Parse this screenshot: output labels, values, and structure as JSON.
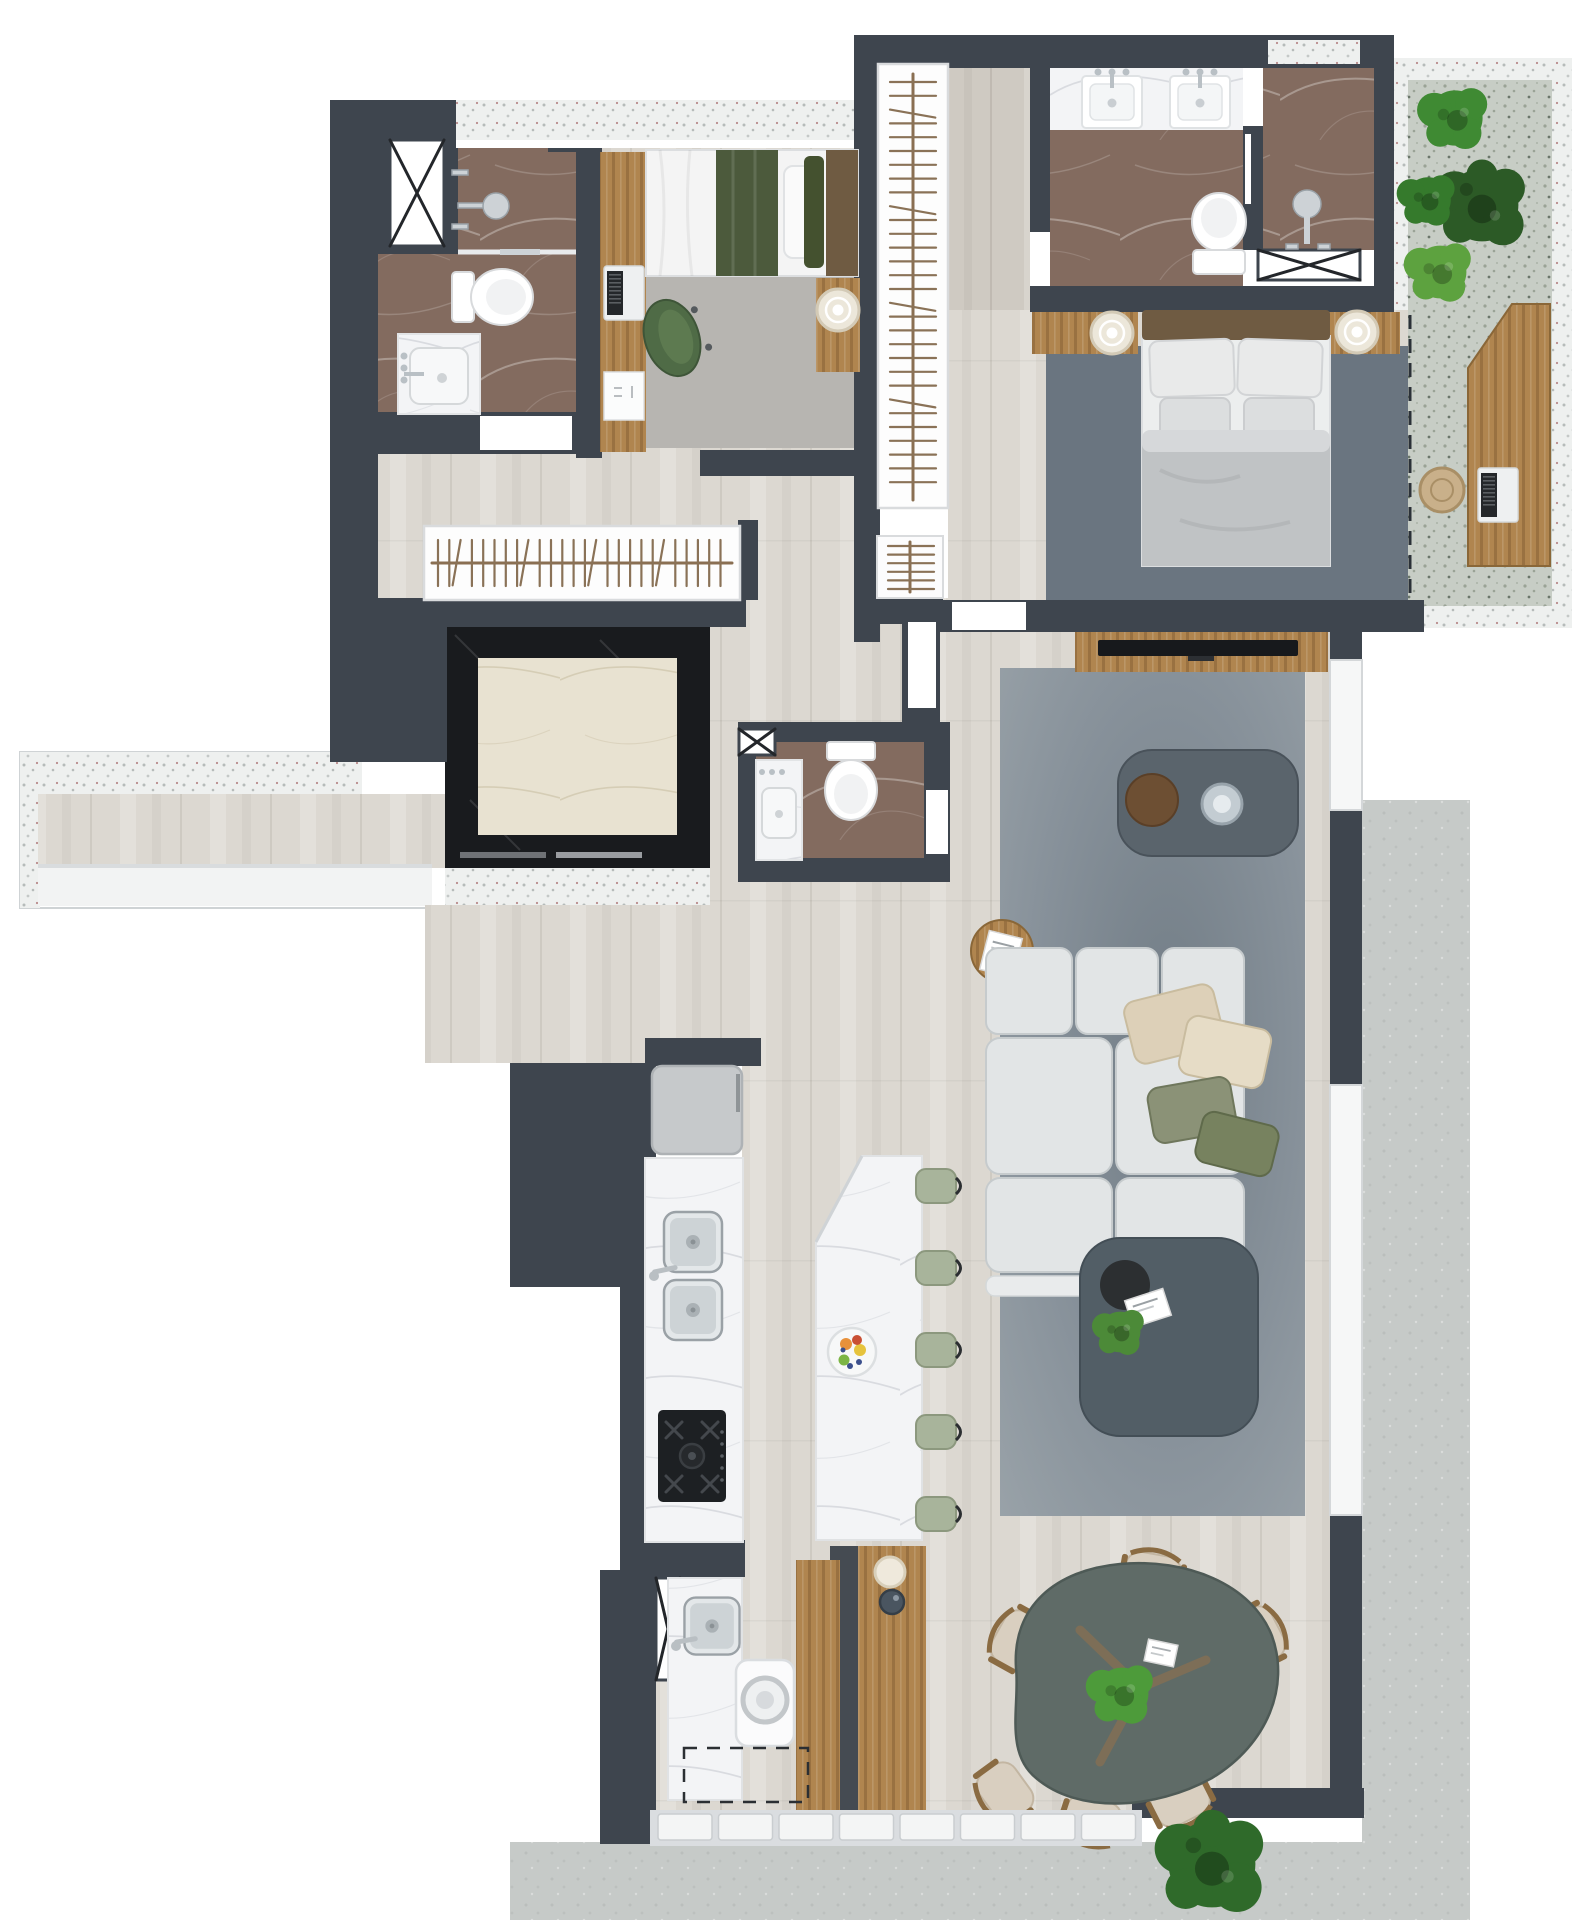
{
  "title": "apartment-floor-plan-top-view",
  "palette": {
    "wall": "#3e454e",
    "floor": "#dcd8d1",
    "floorg": "#cfcac2",
    "wood": "#b0854f",
    "woodDark": "#8a6738",
    "terr": "#eef0ef",
    "conc": "#c6cac8",
    "balc": "#c7cdc5",
    "elevFrame": "#191b1e",
    "elevFloor": "#e8e2d1",
    "marbBr": "#8b7366",
    "marbW": "#f3f4f6",
    "rugLight": "#b7b5b1",
    "rugMaster": "#6a7580",
    "rugLiving": "#9aa3a9",
    "rugLivingDark": "#727d86",
    "sofa": "#e2e5e6",
    "sofaLine": "#c6cbcd",
    "pillowBeige": "#ddd0b8",
    "pillowGreen": "#8b9277",
    "greenChair": "#4f6b46",
    "stool": "#a8b49b",
    "bedGreen": "#4c5a3c",
    "duvet": "#c0c3c5",
    "headboard": "#6f5b42",
    "tableDark": "#5a646c",
    "diningTable": "#5f6b67",
    "chairBeige": "#d9cfc0",
    "steel": "#c9ced1",
    "white": "#ffffff"
  },
  "counts": {
    "hall_closet_hangers": 26,
    "walkin_closet_hangers": 30,
    "entry_closet_hangers": 6,
    "bar_stools": 5,
    "shutter_slats": 8,
    "dining_chairs": 7
  },
  "dining": {
    "chairs": [
      {
        "x": 1018,
        "y": 1640,
        "r": -61
      },
      {
        "x": 1085,
        "y": 1600,
        "r": -24
      },
      {
        "x": 1152,
        "y": 1576,
        "r": 10
      },
      {
        "x": 1258,
        "y": 1636,
        "r": 63
      },
      {
        "x": 1005,
        "y": 1792,
        "r": -126
      },
      {
        "x": 1092,
        "y": 1820,
        "r": 198
      },
      {
        "x": 1180,
        "y": 1800,
        "r": 153
      }
    ]
  },
  "plants": [
    {
      "x": 1455,
      "y": 118,
      "s": 1.15,
      "c": "#3f8a33",
      "href": "#plantA"
    },
    {
      "x": 1482,
      "y": 205,
      "s": 1.3,
      "c": "#2c5a26",
      "href": "#plantB"
    },
    {
      "x": 1428,
      "y": 200,
      "s": 0.95,
      "c": "#357a2c",
      "href": "#plantA"
    },
    {
      "x": 1440,
      "y": 272,
      "s": 1.1,
      "c": "#5da23f",
      "href": "#plantA"
    },
    {
      "x": 1122,
      "y": 1694,
      "s": 1.1,
      "c": "#4d9b3a",
      "href": "#plantA"
    },
    {
      "x": 1120,
      "y": 1332,
      "s": 0.85,
      "c": "#4c8a38",
      "href": "#plantA"
    },
    {
      "x": 1212,
      "y": 1864,
      "s": 1.55,
      "c": "#2f6a2a",
      "href": "#plantB"
    }
  ],
  "rooms": [
    {
      "name": "bathroom-suite-2",
      "furniture": [
        "shower",
        "toilet",
        "vanity-sink",
        "duct-shaft"
      ]
    },
    {
      "name": "bedroom-suite-2",
      "furniture": [
        "single-bed",
        "green-blanket",
        "desk",
        "laptop",
        "office-chair",
        "rug",
        "side-table",
        "round-tray"
      ]
    },
    {
      "name": "hall",
      "furniture": [
        "open-wardrobe-rail"
      ]
    },
    {
      "name": "walk-in-closet",
      "furniture": [
        "hanging-rail"
      ]
    },
    {
      "name": "master-bathroom",
      "furniture": [
        "double-vanity",
        "toilet",
        "shower",
        "duct-shaft"
      ]
    },
    {
      "name": "master-bedroom",
      "furniture": [
        "double-bed",
        "nightstand",
        "nightstand",
        "round-trays",
        "rug",
        "entry-closet",
        "tv-console",
        "tv"
      ]
    },
    {
      "name": "balcony-office",
      "furniture": [
        "wood-desk",
        "laptop",
        "wicker-stool",
        "planter-plants",
        "sliding-door-dashed"
      ]
    },
    {
      "name": "powder-room",
      "furniture": [
        "toilet",
        "vanity-sink",
        "duct-shaft"
      ]
    },
    {
      "name": "elevator",
      "furniture": [
        "black-marble-frame",
        "stone-cab-floor"
      ]
    },
    {
      "name": "kitchen",
      "furniture": [
        "refrigerator",
        "double-steel-sink",
        "gas-cooktop",
        "marble-island",
        "bar-stools",
        "fruit-bowl",
        "sideboard",
        "vases"
      ]
    },
    {
      "name": "laundry",
      "furniture": [
        "utility-sink",
        "washing-machine",
        "future-appliance-dashed",
        "duct-shaft"
      ]
    },
    {
      "name": "living-room",
      "furniture": [
        "sectional-sofa",
        "beige-pillows",
        "green-pillows",
        "coffee-table-glass",
        "coffee-table-large",
        "round-side-table",
        "book",
        "rug"
      ]
    },
    {
      "name": "dining-room",
      "furniture": [
        "organic-dining-table",
        "dining-chairs",
        "center-plant",
        "card"
      ]
    },
    {
      "name": "entry-corridor",
      "furniture": [
        "terrazzo-ledge",
        "wood-deck"
      ]
    }
  ]
}
